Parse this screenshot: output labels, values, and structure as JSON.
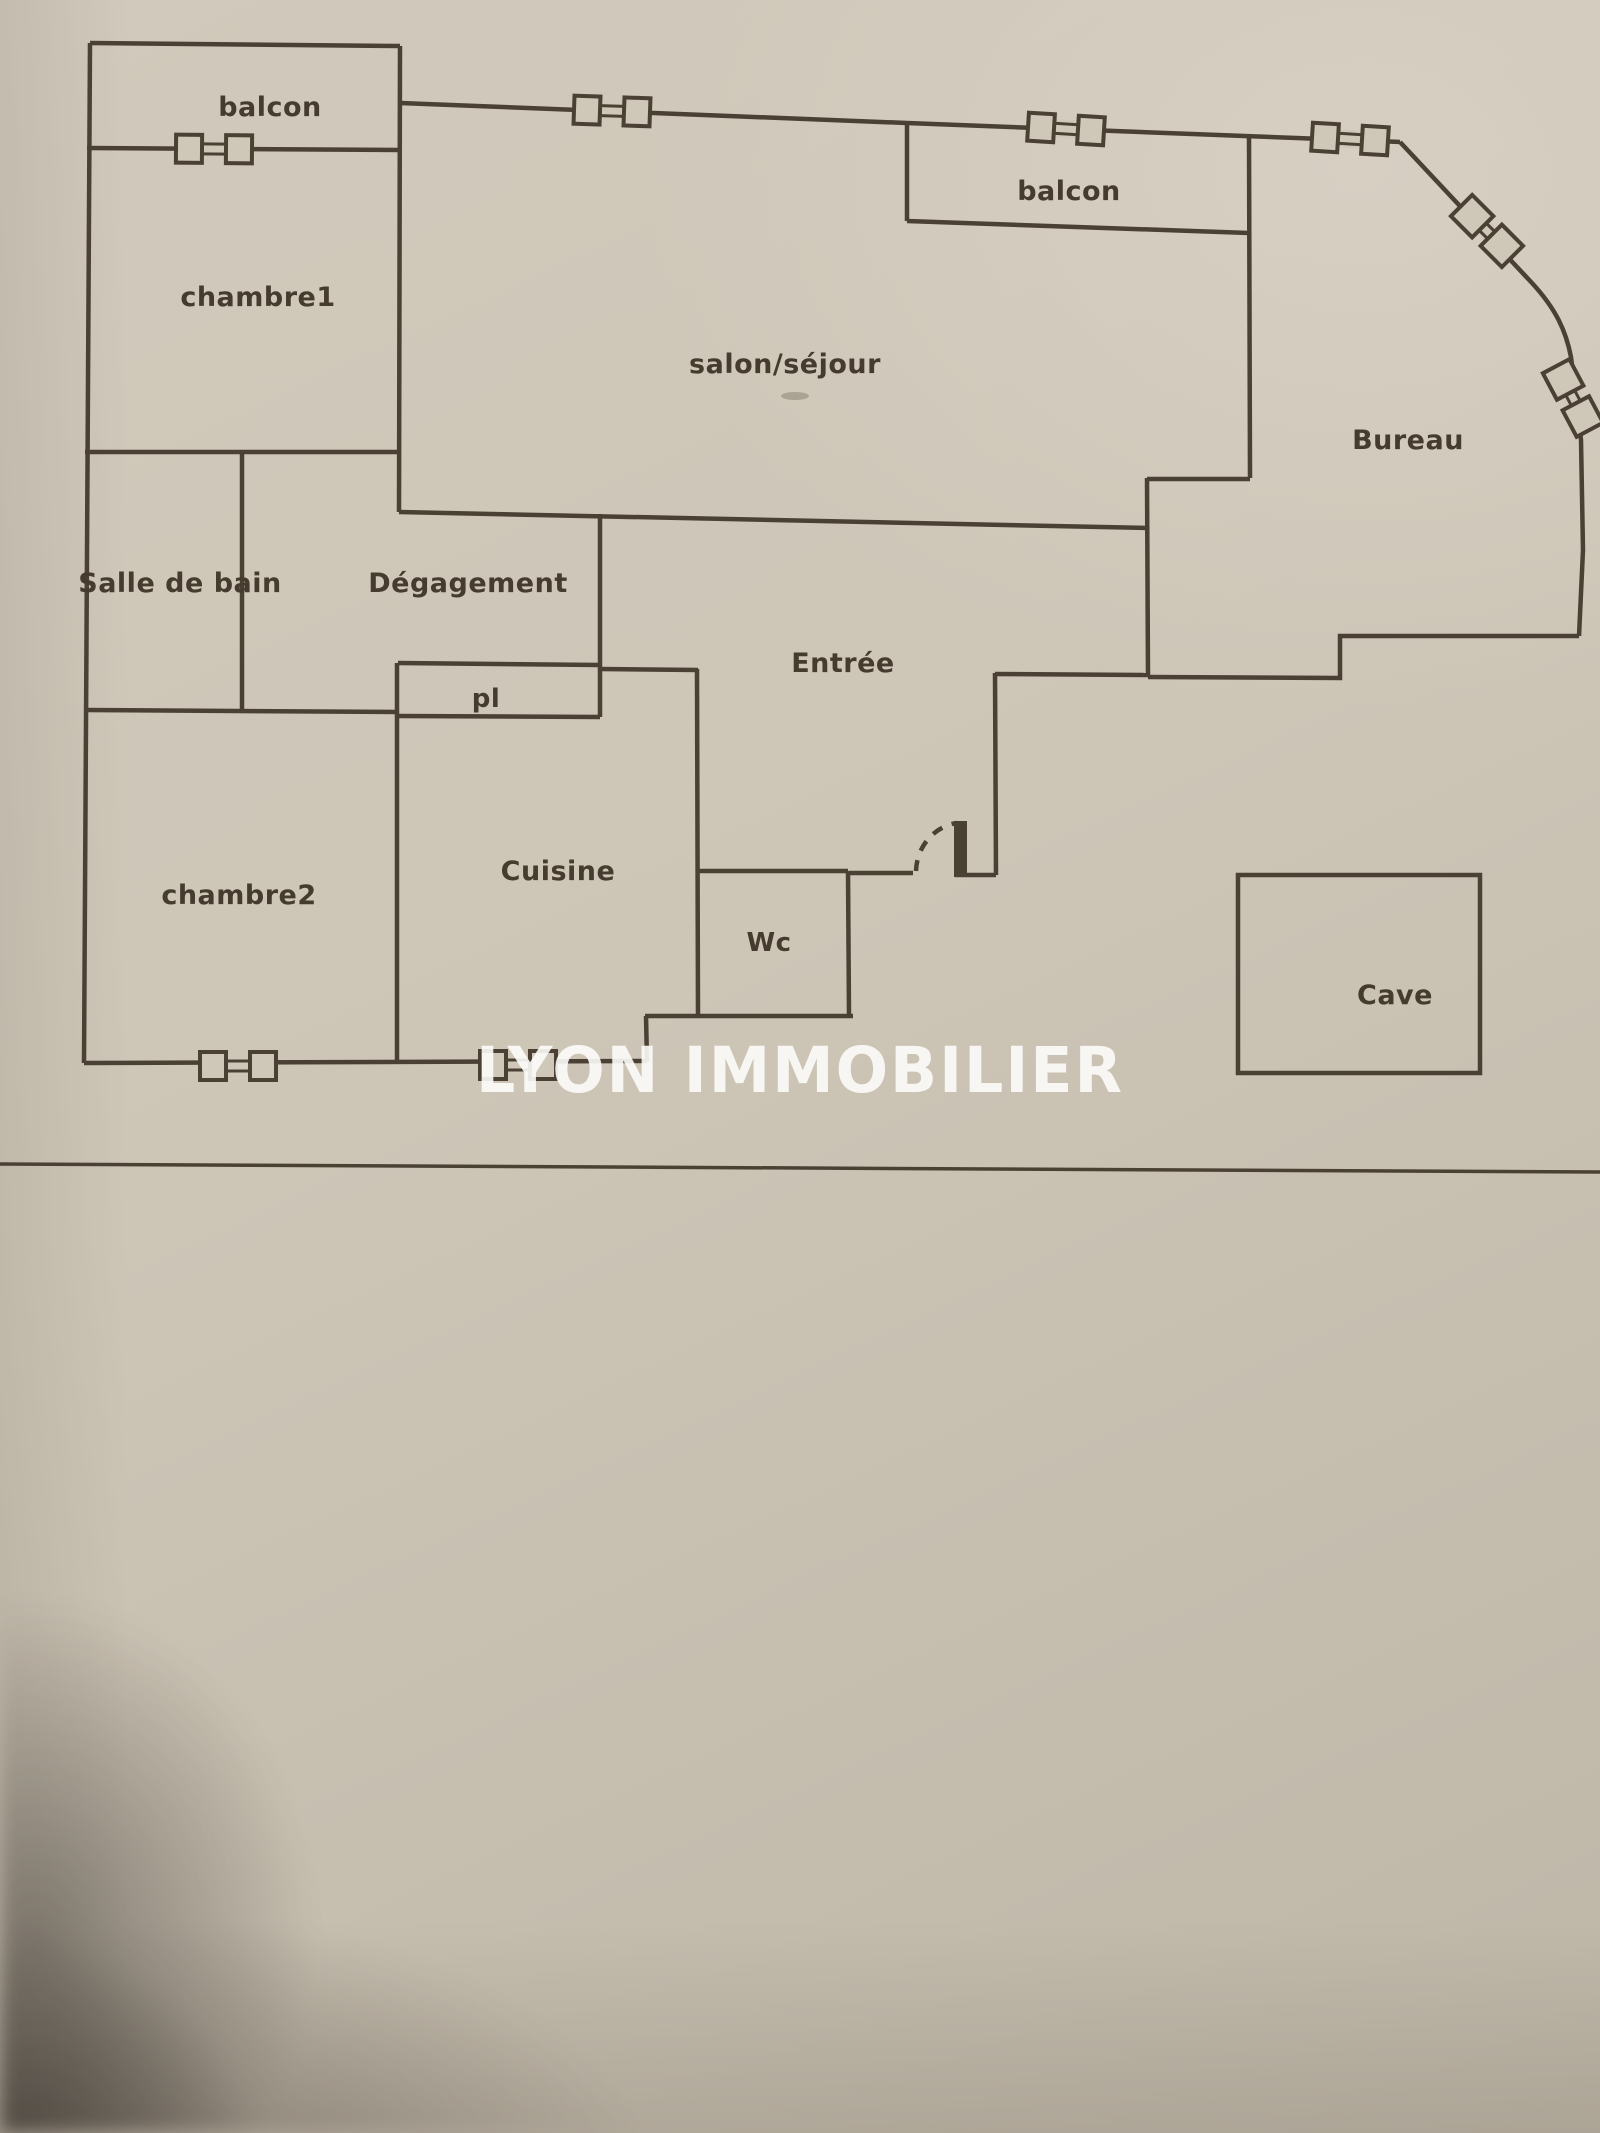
{
  "rooms": {
    "balcon1": "balcon",
    "chambre1": "chambre1",
    "salon": "salon/séjour",
    "balcon2": "balcon",
    "bureau": "Bureau",
    "salle_de_bain": "Salle de bain",
    "degagement": "Dégagement",
    "placard": "pl",
    "entree": "Entrée",
    "chambre2": "chambre2",
    "cuisine": "Cuisine",
    "wc": "Wc",
    "cave": "Cave"
  },
  "watermark": {
    "text": "LYON IMMOBILIER",
    "color": "#fdfcf9"
  },
  "colors": {
    "paper": "#cdc5b6",
    "ink": "#4a4034",
    "corner_shadow": "#2e2822"
  }
}
